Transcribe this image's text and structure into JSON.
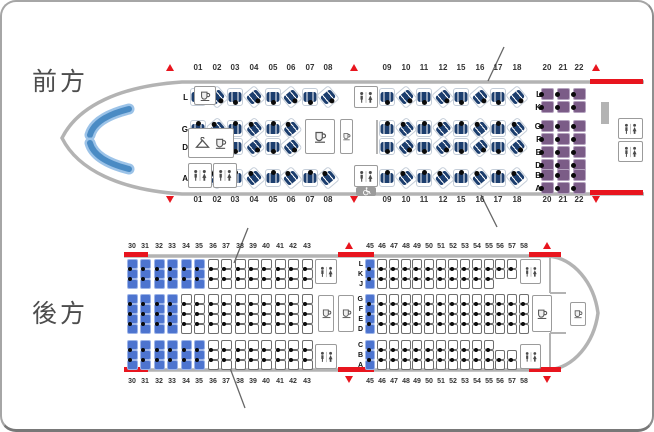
{
  "labels": {
    "front": "前方",
    "rear": "後方"
  },
  "colors": {
    "business_seat": "#1c3e6e",
    "premium_seat": "#7b5c87",
    "premium_seat_border": "#b5a3bf",
    "economy_highlight": "#4d74cf",
    "economy_highlight_border": "#9db4e8",
    "exit_red": "#e8151e",
    "fuselage": "#b3b3b3",
    "cockpit_blue_dark": "#4a8bc4",
    "cockpit_blue_light": "#9cc3e8"
  },
  "front_section": {
    "cabin1_columns": [
      "01",
      "02",
      "03",
      "04",
      "05",
      "06",
      "07",
      "08"
    ],
    "cabin1_middle_row_columns": [
      "01",
      "02",
      "03",
      "04",
      "05",
      "06"
    ],
    "cabin2_columns": [
      "09",
      "10",
      "11",
      "12",
      "15",
      "16",
      "17",
      "18"
    ],
    "premium_columns": [
      "20",
      "21",
      "22"
    ],
    "business_row_letters": [
      "L",
      "G",
      "D",
      "A"
    ],
    "premium_row_letters": [
      "L",
      "K",
      "G",
      "F",
      "E",
      "D",
      "B",
      "A"
    ]
  },
  "rear_section": {
    "left_columns": [
      "30",
      "31",
      "32",
      "33",
      "34",
      "35",
      "36",
      "37",
      "38",
      "39",
      "40",
      "41",
      "42",
      "43"
    ],
    "right_columns": [
      "45",
      "46",
      "47",
      "48",
      "49",
      "50",
      "51",
      "52",
      "53",
      "54",
      "55",
      "56",
      "57",
      "58"
    ],
    "row_letter_groups": [
      [
        "L",
        "K",
        "J"
      ],
      [
        "G",
        "F",
        "E",
        "D"
      ],
      [
        "C",
        "B",
        "A"
      ]
    ],
    "short_top_band_columns": [
      "56",
      "57"
    ],
    "short_top_band_rows": [
      "L",
      "K"
    ],
    "short_bottom_band_columns": [
      "56",
      "57"
    ],
    "short_bottom_band_rows": [
      "B",
      "A"
    ],
    "middle_band_only_column": "58",
    "highlighted": {
      "left_top_band_columns": [
        "30",
        "31",
        "32",
        "33",
        "34",
        "35"
      ],
      "left_middle_band_columns": [
        "30",
        "31",
        "32",
        "33"
      ],
      "left_bottom_band_columns": [
        "30",
        "31",
        "32",
        "33",
        "34",
        "35"
      ],
      "right_all_bands_column": "45"
    }
  },
  "icons": {
    "galley": "galley-cup-icon",
    "lavatory": "lavatory-icon",
    "wardrobe": "coat-hanger-icon",
    "accessible": "wheelchair-icon",
    "cockpit": "cockpit-windshield",
    "exit_up": "exit-triangle-up",
    "exit_down": "exit-triangle-down",
    "exit_bar": "exit-red-bar",
    "break_mark": "fuselage-break-line"
  }
}
